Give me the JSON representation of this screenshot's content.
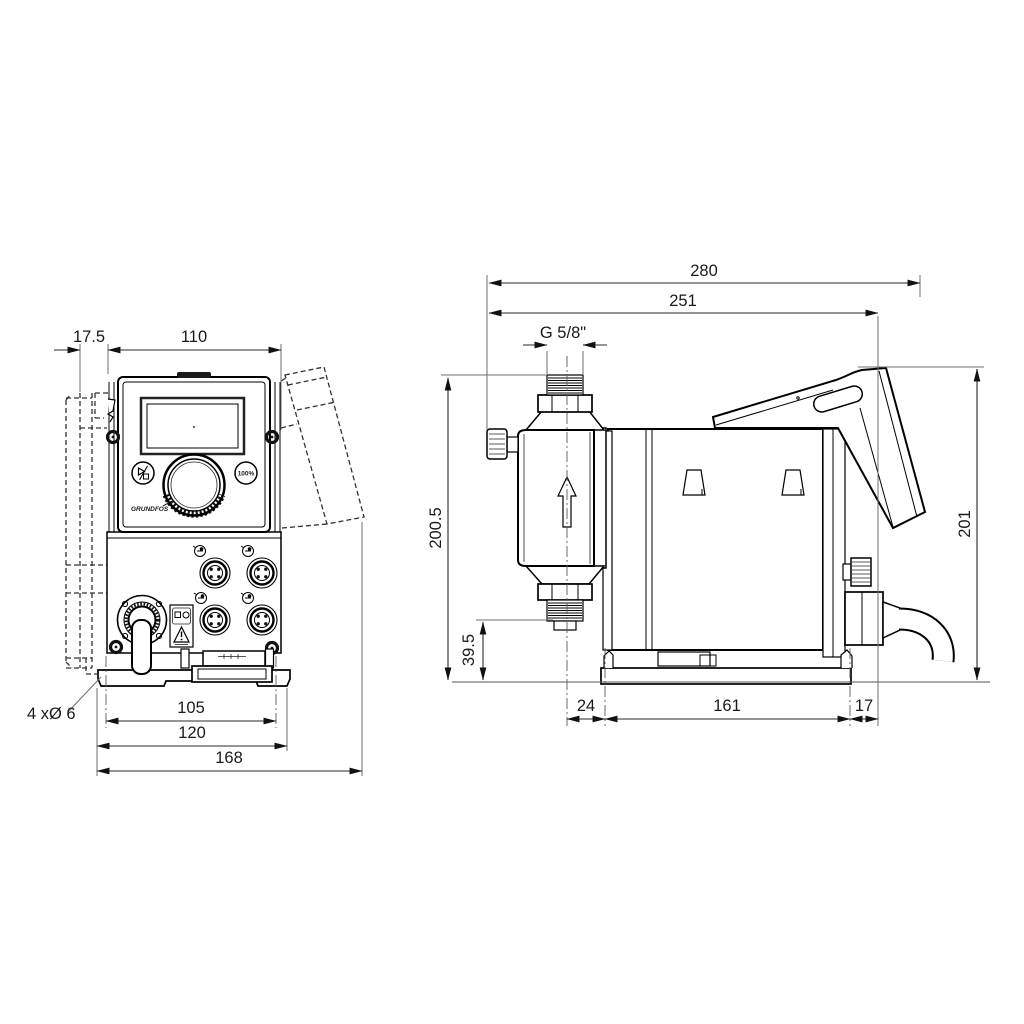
{
  "drawing": {
    "front_view": {
      "dim_offset": "17.5",
      "dim_width": "110",
      "dim_hole_spacing": "105",
      "dim_plate_width": "120",
      "dim_overall_width": "168",
      "mounting_holes": "4 xØ 6",
      "button_right": "100%",
      "logo": "GRUNDFOS"
    },
    "side_view": {
      "dim_overall_depth": "280",
      "dim_depth": "251",
      "thread": "G 5/8\"",
      "dim_height": "200.5",
      "dim_inlet_height": "39.5",
      "dim_rear_height": "201",
      "dim_front": "24",
      "dim_plate_length": "161",
      "dim_rear": "17"
    }
  }
}
